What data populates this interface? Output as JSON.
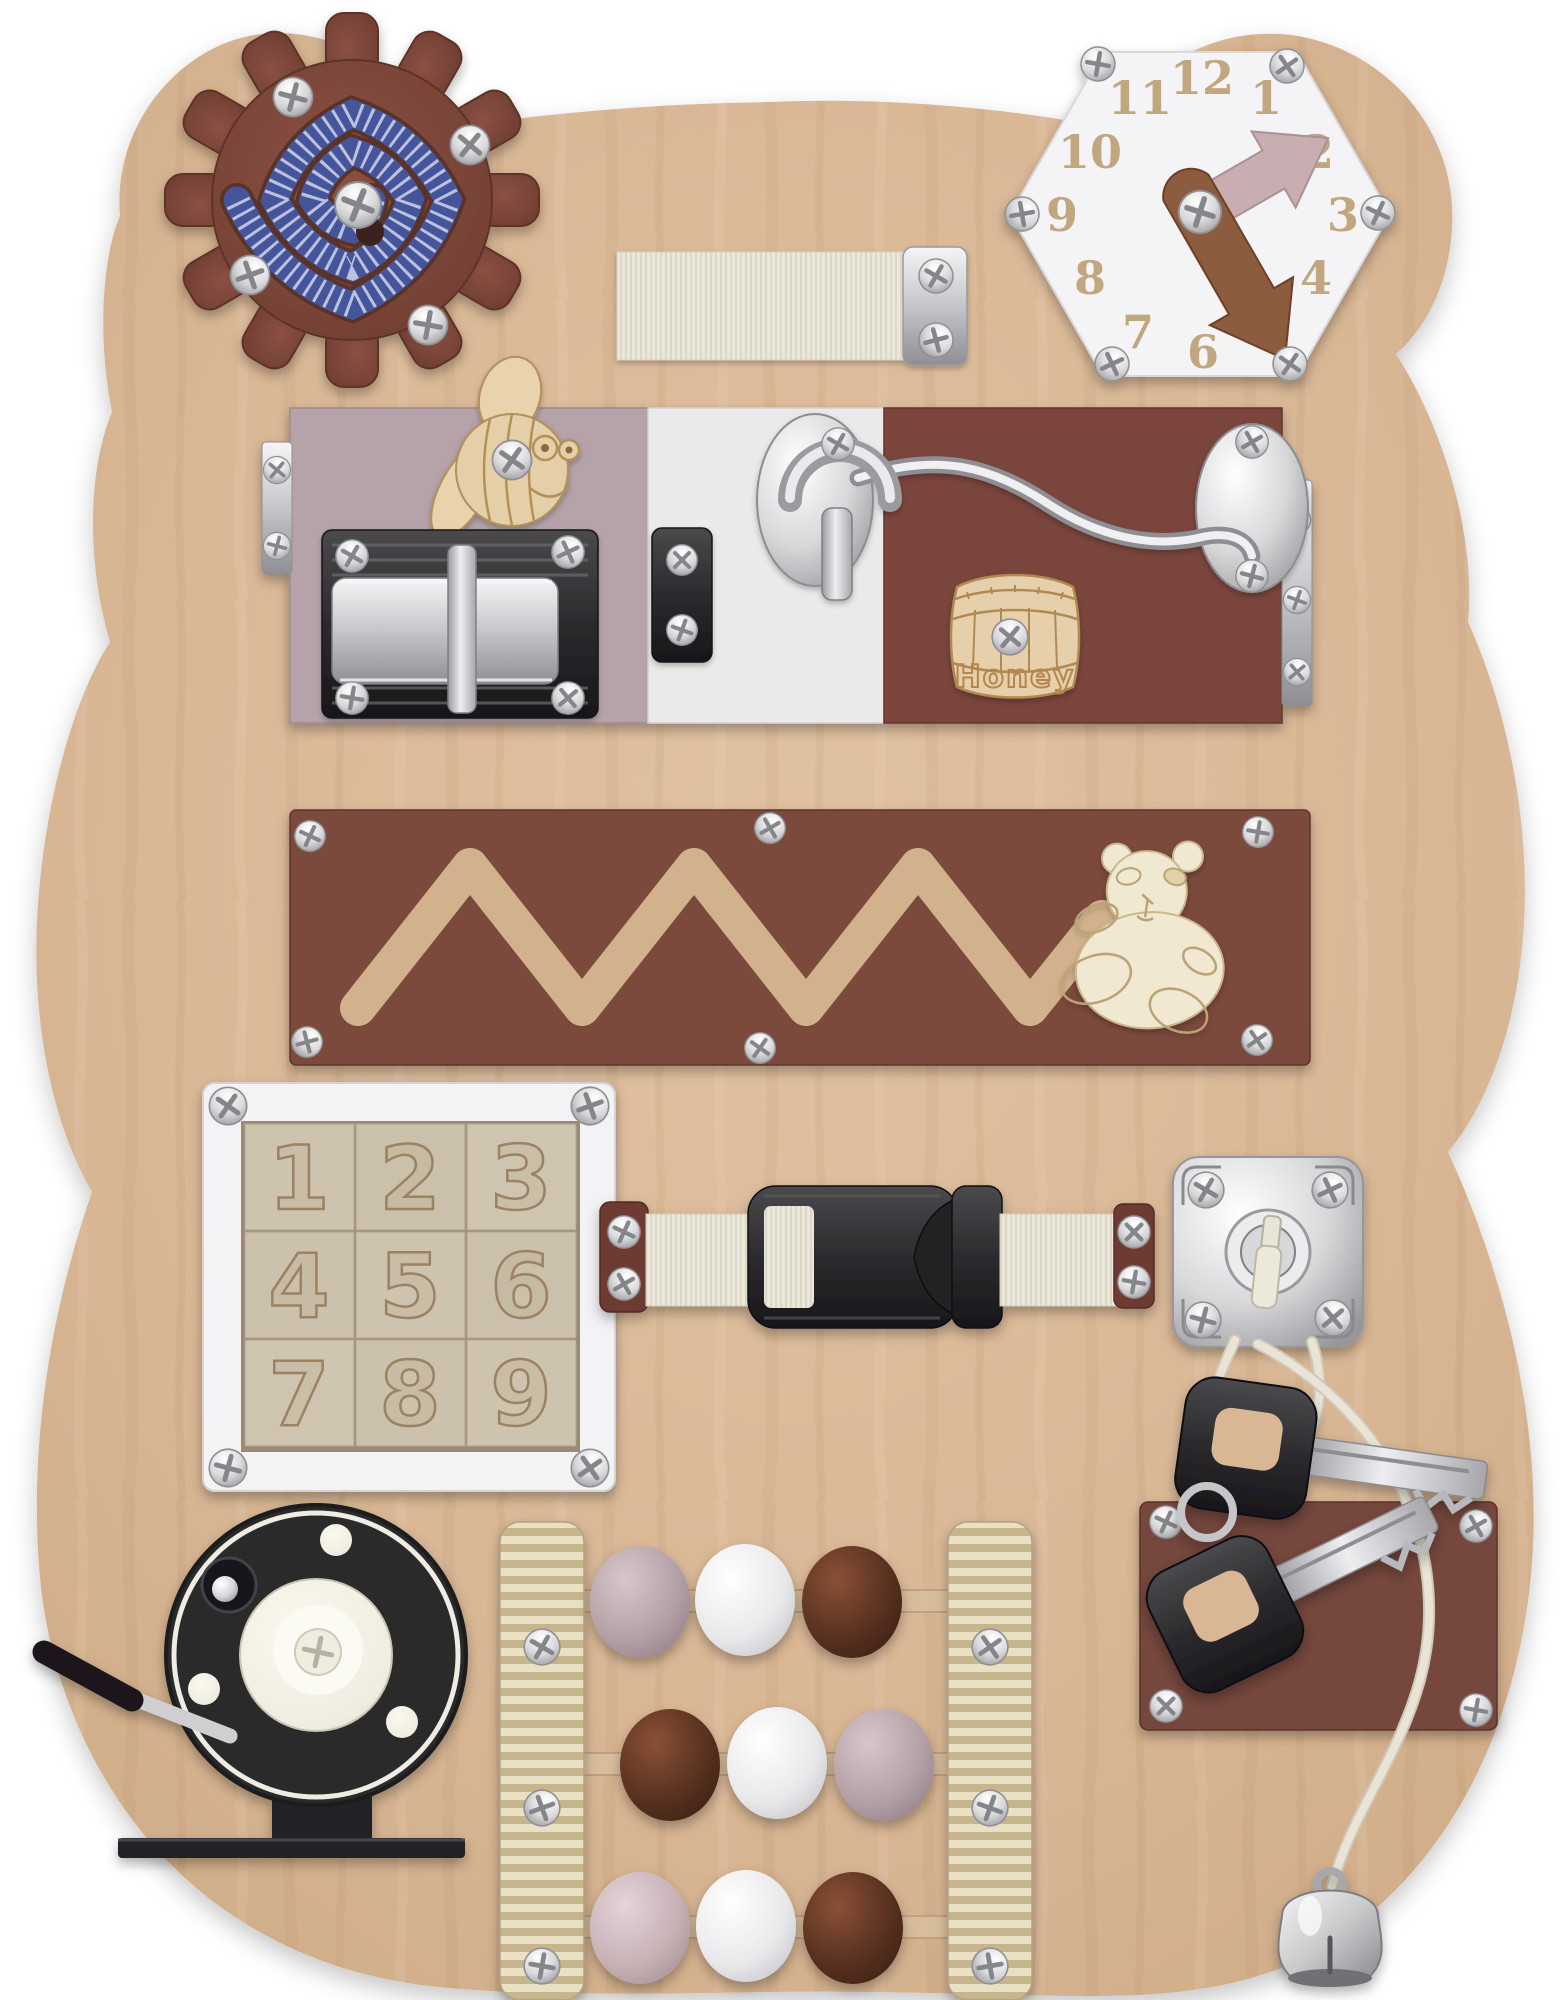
{
  "board": {
    "shape": "teddy-bear silhouette plywood",
    "wood_color": "#d9b795",
    "background_color": "#ffffff"
  },
  "clock": {
    "numbers": [
      "1",
      "2",
      "3",
      "4",
      "5",
      "6",
      "7",
      "8",
      "9",
      "10",
      "11",
      "12"
    ],
    "face_color": "#f4f3f5",
    "minute_hand_color": "#c9aeb1",
    "hour_hand_color": "#8b5b3c",
    "minute_hand_points_to": "2",
    "hour_hand_points_to": "5"
  },
  "gear": {
    "teeth": 12,
    "color": "#7c4537",
    "bead_spiral_colors": [
      "#45549c",
      "#dadded"
    ]
  },
  "latch_doors": {
    "left_color": "#b5a3a9",
    "middle_color": "#ebe9ea",
    "right_color": "#7a453c"
  },
  "honey_barrel": {
    "label": "Honey",
    "wood_color": "#e6d0ab"
  },
  "zigzag_maze": {
    "panel_color": "#7b4a3c",
    "groove_color": "#d2b28c",
    "slider": "teddy-bear"
  },
  "puzzle": {
    "tiles": [
      "1",
      "2",
      "3",
      "4",
      "5",
      "6",
      "7",
      "8",
      "9"
    ],
    "frame_color": "#f3f2f4",
    "tile_color": "#cdc2ae"
  },
  "buckle": {
    "plastic_color": "#2c2b2e",
    "strap_color": "#ebe7da",
    "tab_color": "#6e3a32"
  },
  "lock": {
    "metal_color": "#e2e2e5",
    "key_color": "#ece9db"
  },
  "keys": {
    "count": 2,
    "handle_color": "#2f2e31",
    "panel_color": "#74463c",
    "cord_color": "#e9e4d6"
  },
  "abacus": {
    "rail_stripe_colors": [
      "#eae0c4",
      "#c7b58e"
    ],
    "rows": [
      {
        "bead_colors": [
          "#b3a0a6",
          "#e9e8eb",
          "#56301f"
        ]
      },
      {
        "bead_colors": [
          "#56301f",
          "#e9e8eb",
          "#b3a0a6"
        ]
      },
      {
        "bead_colors": [
          "#c7b1b5",
          "#ebeaec",
          "#56301f"
        ]
      }
    ]
  },
  "reel": {
    "disc_color": "#2b292c",
    "center_color": "#f2efe2"
  },
  "bell": {
    "color": "#c9c9cc"
  }
}
